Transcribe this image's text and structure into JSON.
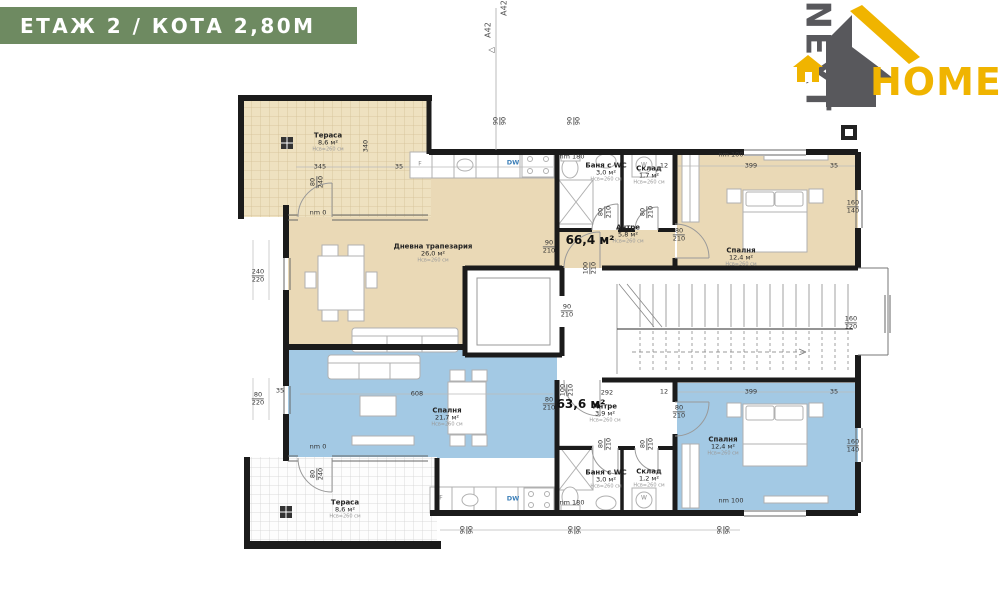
{
  "header": {
    "title": "ЕТАЖ 2 / КОТА 2,80М"
  },
  "logo": {
    "next": "NEXT",
    "home": "HOME"
  },
  "colors": {
    "header_bg": "#6e8a61",
    "apt1_fill": "#ead9b6",
    "apt2_fill": "#a3c9e4",
    "logo_gray": "#58585c",
    "logo_yellow": "#f0b400",
    "wall": "#1b1b1b"
  },
  "apartments": [
    {
      "id": "apartment-1",
      "area_label": "66,4 м²",
      "x": 590,
      "y": 240
    },
    {
      "id": "apartment-2",
      "area_label": "63,6 м²",
      "x": 581,
      "y": 404
    }
  ],
  "rooms": [
    {
      "id": "terrace-1",
      "name": "Тераса",
      "area": "8,6 м²",
      "note": "Hсв=260 см",
      "x": 328,
      "y": 142
    },
    {
      "id": "living-dining-1",
      "name": "Дневна трапезария",
      "area": "26,0 м²",
      "note": "Hсв=260 см",
      "x": 433,
      "y": 253
    },
    {
      "id": "hall-1",
      "name": "Антре",
      "area": "5,8 м²",
      "note": "Hсв=260 см",
      "x": 628,
      "y": 234
    },
    {
      "id": "bath-wc-1",
      "name": "Баня с WC",
      "area": "3,0 м²",
      "note": "Hсв=260 см",
      "x": 606,
      "y": 172
    },
    {
      "id": "storage-1",
      "name": "Склад",
      "area": "1,7 м²",
      "note": "Hсв=260 см",
      "x": 649,
      "y": 175
    },
    {
      "id": "bedroom-1",
      "name": "Спалня",
      "area": "12,4 м²",
      "note": "Hсв=260 см",
      "x": 741,
      "y": 257
    },
    {
      "id": "bedroom-2a",
      "name": "Спалня",
      "area": "21,7 м²",
      "note": "Hсв=260 см",
      "x": 447,
      "y": 417
    },
    {
      "id": "hall-2",
      "name": "Антре",
      "area": "3,9 м²",
      "note": "Hсв=260 см",
      "x": 605,
      "y": 413
    },
    {
      "id": "bath-wc-2",
      "name": "Баня с WC",
      "area": "3,0 м²",
      "note": "Hсв=260 см",
      "x": 606,
      "y": 479
    },
    {
      "id": "storage-2",
      "name": "Склад",
      "area": "1,2 м²",
      "note": "Hсв=260 см",
      "x": 649,
      "y": 478
    },
    {
      "id": "bedroom-2b",
      "name": "Спалня",
      "area": "12,4 м²",
      "note": "Hсв=260 см",
      "x": 723,
      "y": 446
    },
    {
      "id": "terrace-2",
      "name": "Тераса",
      "area": "8,6 м²",
      "note": "Hсв=260 см",
      "x": 345,
      "y": 509
    }
  ],
  "dims": [
    {
      "a": "240",
      "b": "220",
      "x": 258,
      "y": 276
    },
    {
      "a": "80",
      "b": "220",
      "x": 258,
      "y": 399
    },
    {
      "t": "35",
      "x": 280,
      "y": 391
    },
    {
      "t": "345",
      "x": 320,
      "y": 167
    },
    {
      "t": "35",
      "x": 399,
      "y": 167
    },
    {
      "t": "340",
      "x": 366,
      "y": 146,
      "r": -90
    },
    {
      "t": "nm 0",
      "x": 318,
      "y": 213
    },
    {
      "t": "nm 0",
      "x": 318,
      "y": 447
    },
    {
      "a": "80",
      "b": "240",
      "x": 317,
      "y": 182,
      "r": -90
    },
    {
      "a": "80",
      "b": "240",
      "x": 317,
      "y": 474,
      "r": -90
    },
    {
      "t": "nm 180",
      "x": 572,
      "y": 157
    },
    {
      "t": "nm 180",
      "x": 572,
      "y": 503
    },
    {
      "t": "nm 100",
      "x": 731,
      "y": 155
    },
    {
      "t": "nm 100",
      "x": 731,
      "y": 501
    },
    {
      "t": "12",
      "x": 664,
      "y": 166
    },
    {
      "t": "399",
      "x": 751,
      "y": 166
    },
    {
      "t": "35",
      "x": 834,
      "y": 166
    },
    {
      "t": "12",
      "x": 664,
      "y": 392
    },
    {
      "t": "399",
      "x": 751,
      "y": 392
    },
    {
      "t": "35",
      "x": 834,
      "y": 392
    },
    {
      "t": "292",
      "x": 607,
      "y": 393
    },
    {
      "t": "608",
      "x": 417,
      "y": 394
    },
    {
      "a": "90",
      "b": "210",
      "x": 549,
      "y": 247
    },
    {
      "a": "80",
      "b": "210",
      "x": 679,
      "y": 235
    },
    {
      "a": "80",
      "b": "210",
      "x": 605,
      "y": 212,
      "r": -90
    },
    {
      "a": "80",
      "b": "210",
      "x": 647,
      "y": 212,
      "r": -90
    },
    {
      "a": "100",
      "b": "210",
      "x": 590,
      "y": 268,
      "r": -90
    },
    {
      "a": "90",
      "b": "210",
      "x": 567,
      "y": 311
    },
    {
      "a": "160",
      "b": "120",
      "x": 851,
      "y": 323
    },
    {
      "a": "160",
      "b": "140",
      "x": 853,
      "y": 207
    },
    {
      "a": "160",
      "b": "140",
      "x": 853,
      "y": 446
    },
    {
      "a": "80",
      "b": "210",
      "x": 549,
      "y": 404
    },
    {
      "a": "80",
      "b": "210",
      "x": 679,
      "y": 412
    },
    {
      "a": "80",
      "b": "210",
      "x": 605,
      "y": 444,
      "r": -90
    },
    {
      "a": "80",
      "b": "210",
      "x": 647,
      "y": 444,
      "r": -90
    },
    {
      "a": "100",
      "b": "210",
      "x": 567,
      "y": 390,
      "r": -90
    },
    {
      "a": "90",
      "b": "90",
      "x": 500,
      "y": 121,
      "r": -90
    },
    {
      "a": "90",
      "b": "90",
      "x": 574,
      "y": 121,
      "r": -90
    },
    {
      "a": "90",
      "b": "90",
      "x": 467,
      "y": 530,
      "r": -90
    },
    {
      "a": "90",
      "b": "90",
      "x": 575,
      "y": 530,
      "r": -90
    },
    {
      "a": "90",
      "b": "90",
      "x": 724,
      "y": 530,
      "r": -90
    },
    {
      "t": "F",
      "x": 420,
      "y": 165,
      "c": "f"
    },
    {
      "t": "DW",
      "x": 513,
      "y": 163,
      "c": "dw"
    },
    {
      "t": "W",
      "x": 644,
      "y": 166,
      "c": "f"
    },
    {
      "t": "F",
      "x": 441,
      "y": 499,
      "c": "f"
    },
    {
      "t": "DW",
      "x": 513,
      "y": 499,
      "c": "dw"
    },
    {
      "t": "W",
      "x": 644,
      "y": 499,
      "c": "f"
    },
    {
      "t": "A42",
      "x": 489,
      "y": 30,
      "r": -90,
      "c": "marker"
    },
    {
      "t": "A42",
      "x": 505,
      "y": 8,
      "r": -90,
      "c": "marker"
    },
    {
      "t": "△",
      "x": 492,
      "y": 50,
      "r": -90,
      "c": "marker"
    }
  ]
}
